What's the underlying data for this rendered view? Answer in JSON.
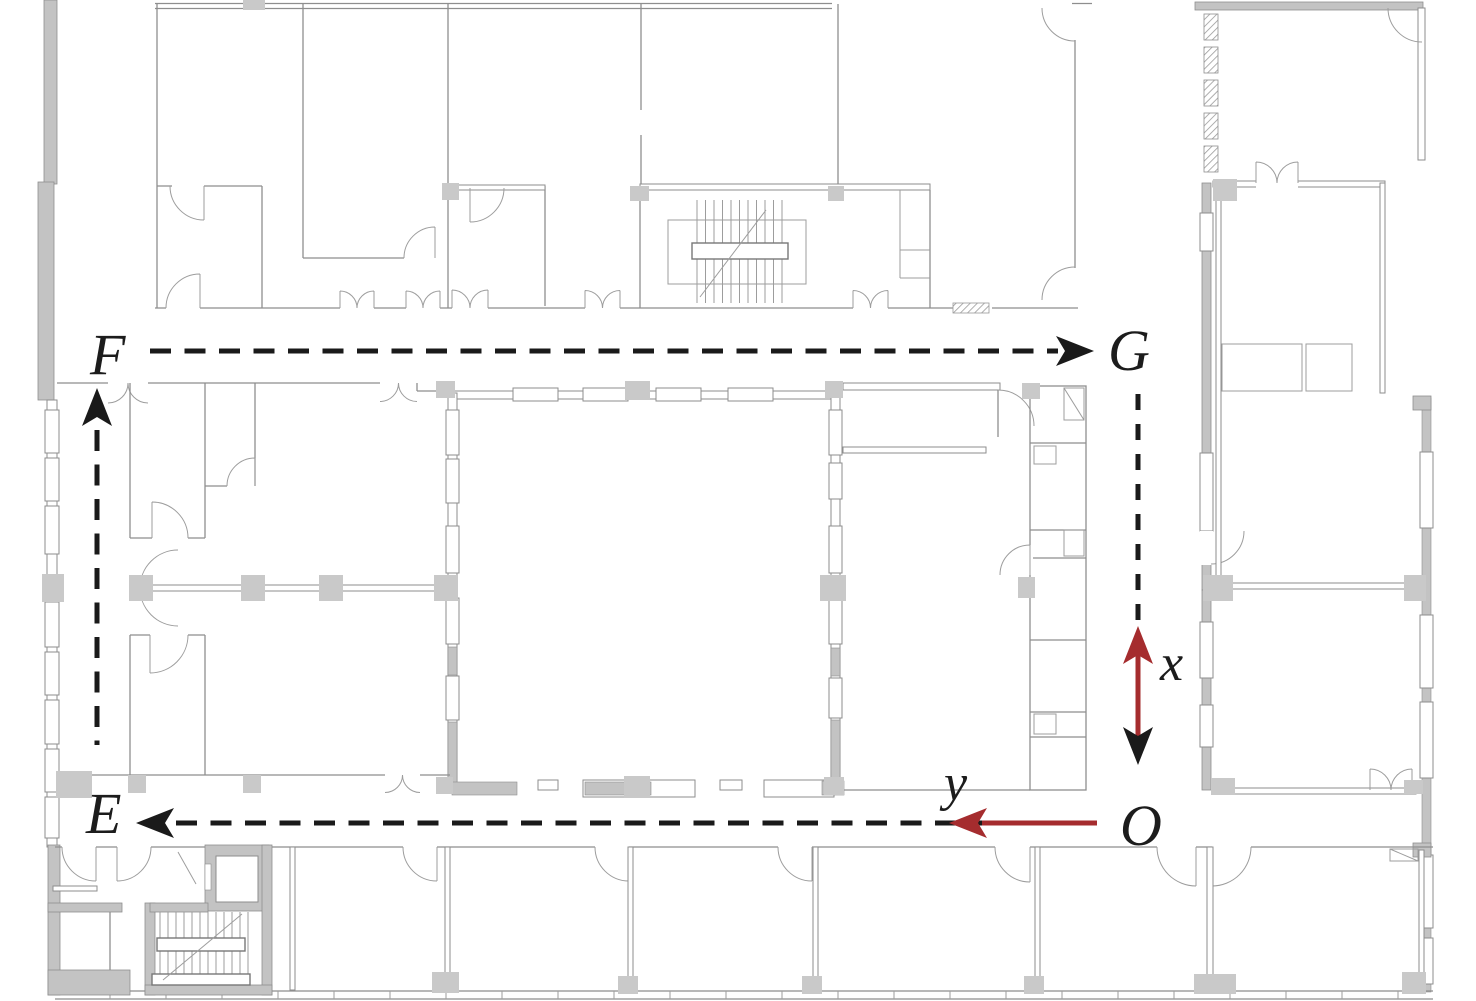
{
  "figure": {
    "kind": "building-floor-plan-with-navigation-path",
    "waypoints": {
      "F": "F",
      "G": "G",
      "E": "E",
      "O": "O"
    },
    "axes": {
      "x_label": "x",
      "y_label": "y"
    },
    "colors": {
      "annotation": "#1a1a1a",
      "axis_red": "#a52c2e",
      "wall": "#8e8e8e",
      "wall_fill": "#c3c3c3",
      "column": "#c9c9c9"
    }
  }
}
